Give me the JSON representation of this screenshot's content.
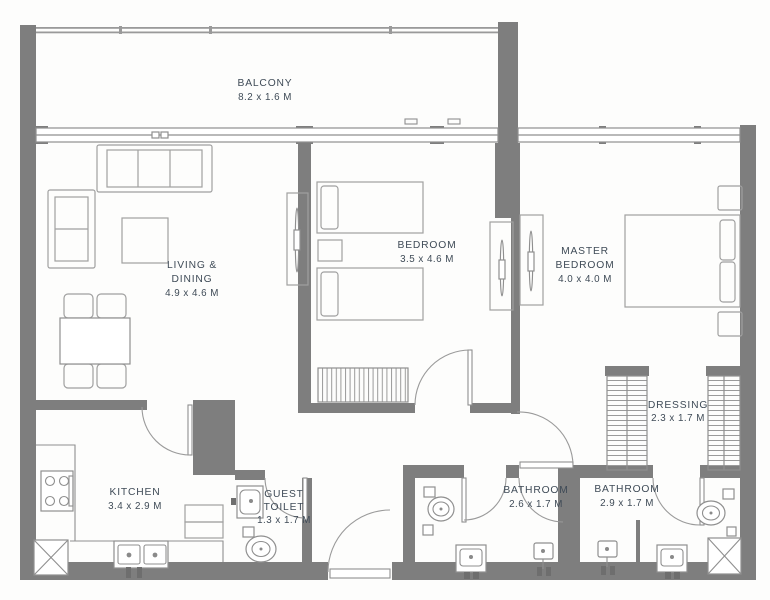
{
  "title": "2 Bedroom Apartment Floor Plan",
  "colors": {
    "wall": "#7e7e7e",
    "furniture_line": "#9a9a9a",
    "text": "#3f4b57",
    "background": "#fdfdfc"
  },
  "rooms": {
    "balcony": {
      "name": "BALCONY",
      "dims": "8.2 x 1.6 M"
    },
    "living_dining": {
      "name": "LIVING &",
      "name2": "DINING",
      "dims": "4.9 x 4.6 M"
    },
    "bedroom": {
      "name": "BEDROOM",
      "dims": "3.5 x 4.6 M"
    },
    "master_bedroom": {
      "name": "MASTER",
      "name2": "BEDROOM",
      "dims": "4.0 x 4.0 M"
    },
    "dressing": {
      "name": "DRESSING",
      "dims": "2.3 x 1.7 M"
    },
    "kitchen": {
      "name": "KITCHEN",
      "dims": "3.4 x 2.9 M"
    },
    "guest_toilet": {
      "name": "GUEST",
      "name2": "TOILET",
      "dims": "1.3 x 1.7 M"
    },
    "bathroom_1": {
      "name": "BATHROOM",
      "dims": "2.6 x 1.7 M"
    },
    "bathroom_2": {
      "name": "BATHROOM",
      "dims": "2.9 x 1.7 M"
    }
  }
}
